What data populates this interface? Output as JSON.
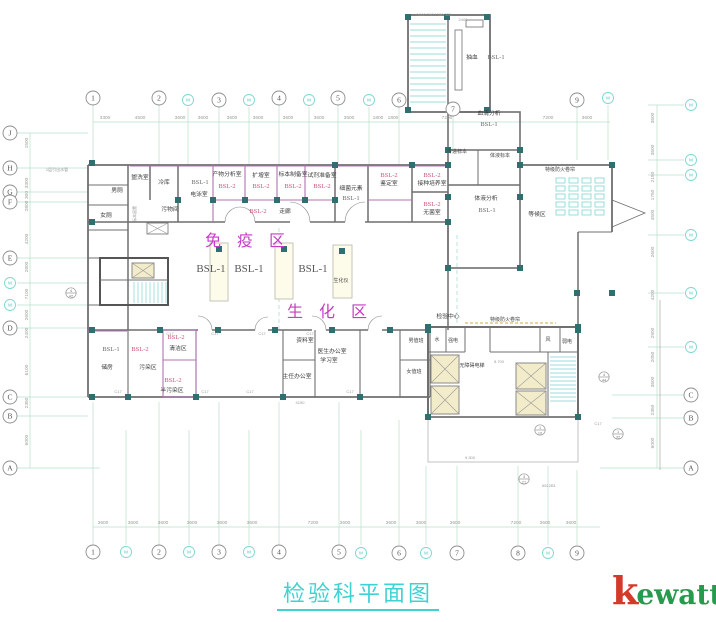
{
  "title": {
    "text": "检验科平面图"
  },
  "logo": {
    "k": "k",
    "rest": "ewatt"
  },
  "colors": {
    "axis_green": "#b8e0cb",
    "axis_cyan": "#7dd6d0",
    "wall": "#6f6f6f",
    "lab_wall": "#b173b1",
    "column": "#2f6f6f",
    "area_label": "#c63cc6",
    "bsl2_label": "#c9537c",
    "title_cyan": "#3fd2d2",
    "logo_red": "#d43a2a",
    "logo_green": "#279a4d",
    "fire_shutter": "#d4a847",
    "stair": "#7fd4cf",
    "shaft_fill": "#f3ecca",
    "bench_fill": "#fdfbea"
  },
  "axes": {
    "top": [
      {
        "l": "1",
        "x": 93,
        "y": 98
      },
      {
        "l": "2",
        "x": 159,
        "y": 98
      },
      {
        "l": "M",
        "x": 188,
        "y": 100,
        "cyan": true
      },
      {
        "l": "3",
        "x": 219,
        "y": 100
      },
      {
        "l": "M",
        "x": 249,
        "y": 100,
        "cyan": true
      },
      {
        "l": "4",
        "x": 279,
        "y": 98
      },
      {
        "l": "M",
        "x": 309,
        "y": 100,
        "cyan": true
      },
      {
        "l": "5",
        "x": 338,
        "y": 98
      },
      {
        "l": "M",
        "x": 369,
        "y": 100,
        "cyan": true
      },
      {
        "l": "6",
        "x": 399,
        "y": 100
      },
      {
        "l": "7",
        "x": 453,
        "y": 109
      },
      {
        "l": "9",
        "x": 577,
        "y": 100
      },
      {
        "l": "M",
        "x": 608,
        "y": 98,
        "cyan": true
      }
    ],
    "bottom": [
      {
        "l": "1",
        "x": 93,
        "y": 552
      },
      {
        "l": "M",
        "x": 126,
        "y": 552,
        "cyan": true
      },
      {
        "l": "2",
        "x": 159,
        "y": 552
      },
      {
        "l": "M",
        "x": 189,
        "y": 552,
        "cyan": true
      },
      {
        "l": "3",
        "x": 219,
        "y": 552
      },
      {
        "l": "M",
        "x": 249,
        "y": 552,
        "cyan": true
      },
      {
        "l": "4",
        "x": 279,
        "y": 552
      },
      {
        "l": "5",
        "x": 339,
        "y": 552
      },
      {
        "l": "M",
        "x": 361,
        "y": 553,
        "cyan": true
      },
      {
        "l": "6",
        "x": 399,
        "y": 553
      },
      {
        "l": "M",
        "x": 426,
        "y": 553,
        "cyan": true
      },
      {
        "l": "7",
        "x": 457,
        "y": 553
      },
      {
        "l": "8",
        "x": 518,
        "y": 553
      },
      {
        "l": "M",
        "x": 548,
        "y": 553,
        "cyan": true
      },
      {
        "l": "9",
        "x": 577,
        "y": 553
      }
    ],
    "left": [
      {
        "l": "J",
        "x": 10,
        "y": 133
      },
      {
        "l": "H",
        "x": 10,
        "y": 168
      },
      {
        "l": "G",
        "x": 10,
        "y": 192
      },
      {
        "l": "F",
        "x": 10,
        "y": 202
      },
      {
        "l": "E",
        "x": 10,
        "y": 258
      },
      {
        "l": "M",
        "x": 10,
        "y": 283,
        "cyan": true
      },
      {
        "l": "M",
        "x": 10,
        "y": 305,
        "cyan": true
      },
      {
        "l": "D",
        "x": 10,
        "y": 328
      },
      {
        "l": "C",
        "x": 10,
        "y": 397
      },
      {
        "l": "B",
        "x": 10,
        "y": 416
      },
      {
        "l": "A",
        "x": 10,
        "y": 468
      }
    ],
    "right": [
      {
        "l": "M",
        "x": 691,
        "y": 105,
        "cyan": true
      },
      {
        "l": "M",
        "x": 691,
        "y": 160,
        "cyan": true
      },
      {
        "l": "M",
        "x": 691,
        "y": 175,
        "cyan": true
      },
      {
        "l": "M",
        "x": 691,
        "y": 235,
        "cyan": true
      },
      {
        "l": "M",
        "x": 691,
        "y": 293,
        "cyan": true
      },
      {
        "l": "M",
        "x": 691,
        "y": 347,
        "cyan": true
      },
      {
        "l": "C",
        "x": 691,
        "y": 395
      },
      {
        "l": "B",
        "x": 691,
        "y": 418
      },
      {
        "l": "A",
        "x": 691,
        "y": 468
      }
    ]
  },
  "dims": {
    "top": [
      {
        "t": "3300",
        "x": 105
      },
      {
        "t": "4500",
        "x": 140
      },
      {
        "t": "3600",
        "x": 180
      },
      {
        "t": "3600",
        "x": 203
      },
      {
        "t": "3600",
        "x": 232
      },
      {
        "t": "3600",
        "x": 258
      },
      {
        "t": "3600",
        "x": 288
      },
      {
        "t": "3600",
        "x": 319
      },
      {
        "t": "3500",
        "x": 349
      },
      {
        "t": "1800",
        "x": 378
      },
      {
        "t": "1800",
        "x": 393
      },
      {
        "t": "7200",
        "x": 447
      },
      {
        "t": "7200",
        "x": 548
      },
      {
        "t": "3600",
        "x": 587
      }
    ],
    "bottom": [
      {
        "t": "3600",
        "x": 103
      },
      {
        "t": "3600",
        "x": 133
      },
      {
        "t": "3600",
        "x": 163
      },
      {
        "t": "3600",
        "x": 192
      },
      {
        "t": "3600",
        "x": 222
      },
      {
        "t": "3600",
        "x": 252
      },
      {
        "t": "7200",
        "x": 313
      },
      {
        "t": "3600",
        "x": 345
      },
      {
        "t": "3600",
        "x": 391
      },
      {
        "t": "3600",
        "x": 421
      },
      {
        "t": "3600",
        "x": 455
      },
      {
        "t": "7200",
        "x": 516
      },
      {
        "t": "3600",
        "x": 545
      },
      {
        "t": "3600",
        "x": 571
      }
    ],
    "left": [
      {
        "t": "1500",
        "y": 143
      },
      {
        "t": "3300",
        "y": 183
      },
      {
        "t": "300",
        "y": 195
      },
      {
        "t": "2800",
        "y": 206
      },
      {
        "t": "4200",
        "y": 239
      },
      {
        "t": "2800",
        "y": 267
      },
      {
        "t": "7100",
        "y": 294
      },
      {
        "t": "2600",
        "y": 315
      },
      {
        "t": "2400",
        "y": 333
      },
      {
        "t": "6100",
        "y": 370
      },
      {
        "t": "2350",
        "y": 403
      },
      {
        "t": "6000",
        "y": 440
      }
    ],
    "right": [
      {
        "t": "3600",
        "y": 118
      },
      {
        "t": "3600",
        "y": 150
      },
      {
        "t": "2150",
        "y": 177
      },
      {
        "t": "1750",
        "y": 195
      },
      {
        "t": "4500",
        "y": 215
      },
      {
        "t": "2600",
        "y": 252
      },
      {
        "t": "4200",
        "y": 295
      },
      {
        "t": "2900",
        "y": 333
      },
      {
        "t": "2050",
        "y": 357
      },
      {
        "t": "3600",
        "y": 382
      },
      {
        "t": "2350",
        "y": 410
      },
      {
        "t": "6000",
        "y": 443
      }
    ]
  },
  "labels": [
    {
      "t": "盥洗室",
      "x": 140,
      "y": 179,
      "c": "room"
    },
    {
      "t": "男厕",
      "x": 117,
      "y": 192,
      "c": "room"
    },
    {
      "t": "女厕",
      "x": 106,
      "y": 217,
      "c": "room"
    },
    {
      "t": "标本留置",
      "x": 136,
      "y": 214,
      "c": "tiny",
      "v": 1
    },
    {
      "t": "冷库",
      "x": 164,
      "y": 184,
      "c": "room"
    },
    {
      "t": "污物间",
      "x": 170,
      "y": 211,
      "c": "room"
    },
    {
      "t": "BSL-1",
      "x": 200,
      "y": 184,
      "c": "bsl1"
    },
    {
      "t": "电泳室",
      "x": 199,
      "y": 196,
      "c": "room"
    },
    {
      "t": "产物分析室",
      "x": 227,
      "y": 176,
      "c": "room"
    },
    {
      "t": "BSL-2",
      "x": 227,
      "y": 188,
      "c": "bsl2"
    },
    {
      "t": "扩增室",
      "x": 261,
      "y": 177,
      "c": "room"
    },
    {
      "t": "BSL-2",
      "x": 261,
      "y": 188,
      "c": "bsl2"
    },
    {
      "t": "标本制备室",
      "x": 293,
      "y": 176,
      "c": "room"
    },
    {
      "t": "BSL-2",
      "x": 293,
      "y": 188,
      "c": "bsl2"
    },
    {
      "t": "试剂准备室",
      "x": 322,
      "y": 177,
      "c": "room"
    },
    {
      "t": "BSL-2",
      "x": 322,
      "y": 188,
      "c": "bsl2"
    },
    {
      "t": "细菌元素",
      "x": 351,
      "y": 190,
      "c": "room"
    },
    {
      "t": "BSL-1",
      "x": 351,
      "y": 200,
      "c": "bsl1"
    },
    {
      "t": "BSL-2",
      "x": 389,
      "y": 177,
      "c": "bsl2"
    },
    {
      "t": "鉴定室",
      "x": 389,
      "y": 185,
      "c": "room"
    },
    {
      "t": "BSL-2",
      "x": 432,
      "y": 177,
      "c": "bsl2"
    },
    {
      "t": "接种培养室",
      "x": 432,
      "y": 185,
      "c": "room"
    },
    {
      "t": "BSL-2",
      "x": 432,
      "y": 206,
      "c": "bsl2"
    },
    {
      "t": "无菌室",
      "x": 432,
      "y": 214,
      "c": "room"
    },
    {
      "t": "BSL-2",
      "x": 258,
      "y": 213,
      "c": "bsl2"
    },
    {
      "t": "走廊",
      "x": 285,
      "y": 213,
      "c": "room"
    },
    {
      "t": "免 疫 区",
      "x": 248,
      "y": 246,
      "c": "area"
    },
    {
      "t": "BSL-1",
      "x": 211,
      "y": 272,
      "c": "bsl1big"
    },
    {
      "t": "BSL-1",
      "x": 249,
      "y": 272,
      "c": "bsl1big"
    },
    {
      "t": "BSL-1",
      "x": 313,
      "y": 272,
      "c": "bsl1big"
    },
    {
      "t": "生化仪",
      "x": 341,
      "y": 282,
      "c": "sm"
    },
    {
      "t": "生 化 区",
      "x": 330,
      "y": 317,
      "c": "area"
    },
    {
      "t": "抽血",
      "x": 472,
      "y": 59,
      "c": "room"
    },
    {
      "t": "BSL-1",
      "x": 496,
      "y": 59,
      "c": "bsl1"
    },
    {
      "t": "血清分析",
      "x": 489,
      "y": 115,
      "c": "room"
    },
    {
      "t": "BSL-1",
      "x": 489,
      "y": 126,
      "c": "bsl1"
    },
    {
      "t": "传递标本",
      "x": 457,
      "y": 153,
      "c": "sm"
    },
    {
      "t": "体液标本",
      "x": 500,
      "y": 157,
      "c": "sm"
    },
    {
      "t": "体液分析",
      "x": 486,
      "y": 200,
      "c": "room"
    },
    {
      "t": "BSL-1",
      "x": 487,
      "y": 212,
      "c": "bsl1"
    },
    {
      "t": "等候区",
      "x": 537,
      "y": 216,
      "c": "room"
    },
    {
      "t": "特级防火卷帘",
      "x": 560,
      "y": 171,
      "c": "sm"
    },
    {
      "t": "检验中心",
      "x": 448,
      "y": 318,
      "c": "room"
    },
    {
      "t": "特级防火卷帘",
      "x": 505,
      "y": 321,
      "c": "sm"
    },
    {
      "t": "BSL-1",
      "x": 111,
      "y": 351,
      "c": "bsl1"
    },
    {
      "t": "储房",
      "x": 107,
      "y": 369,
      "c": "room"
    },
    {
      "t": "BSL-2",
      "x": 140,
      "y": 351,
      "c": "bsl2"
    },
    {
      "t": "污染区",
      "x": 148,
      "y": 369,
      "c": "room"
    },
    {
      "t": "BSL-2",
      "x": 176,
      "y": 339,
      "c": "bsl2"
    },
    {
      "t": "清洁区",
      "x": 178,
      "y": 350,
      "c": "room"
    },
    {
      "t": "BSL-2",
      "x": 173,
      "y": 382,
      "c": "bsl2"
    },
    {
      "t": "半污染区",
      "x": 172,
      "y": 392,
      "c": "room"
    },
    {
      "t": "资料室",
      "x": 305,
      "y": 342,
      "c": "room"
    },
    {
      "t": "主任办公室",
      "x": 297,
      "y": 378,
      "c": "room"
    },
    {
      "t": "医生办公室",
      "x": 332,
      "y": 353,
      "c": "room"
    },
    {
      "t": "学习室",
      "x": 329,
      "y": 362,
      "c": "room"
    },
    {
      "t": "男值班",
      "x": 416,
      "y": 342,
      "c": "sm"
    },
    {
      "t": "女值班",
      "x": 414,
      "y": 373,
      "c": "sm"
    },
    {
      "t": "水",
      "x": 437,
      "y": 341,
      "c": "sm"
    },
    {
      "t": "强电",
      "x": 453,
      "y": 342,
      "c": "sm"
    },
    {
      "t": "无障碍电梯",
      "x": 472,
      "y": 367,
      "c": "sm"
    },
    {
      "t": "8.700",
      "x": 499,
      "y": 363,
      "c": "tiny"
    },
    {
      "t": "风",
      "x": 548,
      "y": 341,
      "c": "sm"
    },
    {
      "t": "弱电",
      "x": 567,
      "y": 343,
      "c": "sm"
    },
    {
      "t": "9.300",
      "x": 470,
      "y": 459,
      "c": "tiny"
    },
    {
      "t": "1层引出水管",
      "x": 57,
      "y": 171,
      "c": "tiny"
    },
    {
      "t": "4150",
      "x": 300,
      "y": 404,
      "c": "tiny"
    },
    {
      "t": "2400",
      "x": 463,
      "y": 21,
      "c": "tiny"
    },
    {
      "t": "1000 290 1500 300",
      "x": 434,
      "y": 16,
      "c": "tiny"
    },
    {
      "t": "6512B1",
      "x": 549,
      "y": 487,
      "c": "tiny"
    },
    {
      "t": "C17",
      "x": 170,
      "y": 335,
      "c": "tiny"
    },
    {
      "t": "C17",
      "x": 215,
      "y": 335,
      "c": "tiny"
    },
    {
      "t": "C17",
      "x": 262,
      "y": 335,
      "c": "tiny"
    },
    {
      "t": "C17",
      "x": 310,
      "y": 335,
      "c": "tiny"
    },
    {
      "t": "C17",
      "x": 118,
      "y": 393,
      "c": "tiny"
    },
    {
      "t": "C17",
      "x": 205,
      "y": 393,
      "c": "tiny"
    },
    {
      "t": "C17",
      "x": 250,
      "y": 393,
      "c": "tiny"
    },
    {
      "t": "C17",
      "x": 350,
      "y": 393,
      "c": "tiny"
    },
    {
      "t": "C17",
      "x": 598,
      "y": 425,
      "c": "tiny"
    }
  ],
  "bubbles": [
    {
      "top": "4",
      "bot": "42",
      "x": 71,
      "y": 293
    },
    {
      "top": "4",
      "bot": "44",
      "x": 604,
      "y": 377
    },
    {
      "top": "1",
      "bot": "10",
      "x": 540,
      "y": 430
    },
    {
      "top": "1",
      "bot": "32",
      "x": 618,
      "y": 434
    },
    {
      "top": "3",
      "bot": "21",
      "x": 524,
      "y": 479
    }
  ]
}
